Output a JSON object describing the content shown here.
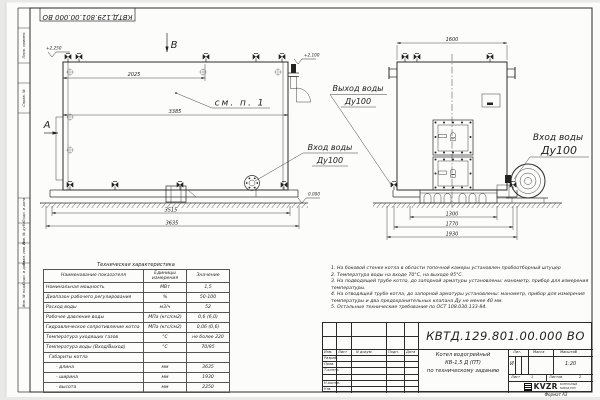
{
  "colors": {
    "line": "#2b2b2b",
    "paper": "#fcfcfa",
    "background": "#e9e9e7"
  },
  "frame": {
    "doc_number_top": "КВТД.129.801.00.000 ВО",
    "format_label": "Формат А3",
    "left_labels": [
      "Перв. примен.",
      "Справ. №",
      "Подп. и дата",
      "Инв. № дубл.",
      "Взам. инв. №",
      "Подп. и дата",
      "Инв. № подл."
    ]
  },
  "views": {
    "side": {
      "view_arrow_label": "В",
      "section_label": "А",
      "see_note": "см. п. 1",
      "dim_top": "2025",
      "dim_mid": "3385",
      "dim_bottom1": "3515",
      "dim_bottom2": "3635",
      "elev_top_left": "+2.250",
      "elev_top_right": "+2.100",
      "elev_ground": "0.000"
    },
    "front": {
      "dim_top": "1600",
      "dim_b1": "1300",
      "dim_b2": "1770",
      "dim_b3": "1930"
    },
    "labels": {
      "outlet_title": "Выход воды",
      "outlet_size": "Ду100",
      "inlet_left_title": "Вход воды",
      "inlet_left_size": "Ду100",
      "inlet_right_title": "Вход воды",
      "inlet_right_size": "Ду100"
    }
  },
  "tech_table": {
    "title": "Техническая характеристика",
    "headers": {
      "name": "Наименование показателя",
      "units": "Единицы\nизмерения",
      "value": "Значение"
    },
    "rows": [
      {
        "name": "Номинальная мощность",
        "units": "МВт",
        "value": "1,5"
      },
      {
        "name": "Диапазон рабочего регулирования",
        "units": "%",
        "value": "50-100"
      },
      {
        "name": "Расход воды",
        "units": "м3/ч",
        "value": "52"
      },
      {
        "name": "Рабочее давление воды",
        "units": "МПа (кгс/см2)",
        "value": "0,6 (6,0)"
      },
      {
        "name": "Гидравлическое сопротивление котла",
        "units": "МПа (кгс/см2)",
        "value": "0,06 (0,6)"
      },
      {
        "name": "Температура уходящих газов",
        "units": "°С",
        "value": "не более 220"
      },
      {
        "name": "Температура воды (Вход/Выход)",
        "units": "°С",
        "value": "70/95"
      },
      {
        "name": "Габариты котла",
        "units": "",
        "value": ""
      },
      {
        "name": "- длина",
        "units": "мм",
        "value": "3635"
      },
      {
        "name": "- ширина",
        "units": "мм",
        "value": "1930"
      },
      {
        "name": "- высота",
        "units": "мм",
        "value": "2250"
      }
    ]
  },
  "notes": {
    "items": [
      "1. На боковой стенке котла в области топочной камеры установлен пробоотборный штуцер",
      "2. Температура воды на входе 70°С, на выходе 95°С.",
      "3. На подводящей трубе котла, до запорной арматуры установлены: манометр, прибор для измерения температуры.",
      "4. На отводящей трубе котла, до запорной арматуры установлены: манометр, прибор для измерения температуры и два предохранительных клапана Ду не менее 40 мм.",
      "5. Остальные технические требования по ОСТ 108.030.133-84."
    ]
  },
  "title_block": {
    "doc_number": "КВТД.129.801.00.000 ВО",
    "col_izm": "Изм.",
    "col_list": "Лист",
    "col_doc": "N докум.",
    "col_sign": "Подп.",
    "col_date": "Дата",
    "row_razrab": "Разраб.",
    "row_prov": "Пров.",
    "row_tkontr": "Т.контр.",
    "row_nkontr": "Н.контр.",
    "row_utv": "Утв.",
    "title_line1": "Котел водогрейный",
    "title_line2": "КВ-1,5 Д (ПТ)",
    "title_line3": "по техническому заданию",
    "lit_label": "Лит.",
    "lit_value": "И",
    "mass_label": "Масса",
    "scale_label": "Масштаб",
    "scale_value": "1:20",
    "sheet_label": "Лист",
    "sheet_value": "1",
    "sheets_label": "Листов",
    "sheets_value": "2",
    "logo_text": "KVZR",
    "logo_caption1": "КОТЕЛЬНЫЙ",
    "logo_caption2": "ЗАВОД РЭП"
  }
}
